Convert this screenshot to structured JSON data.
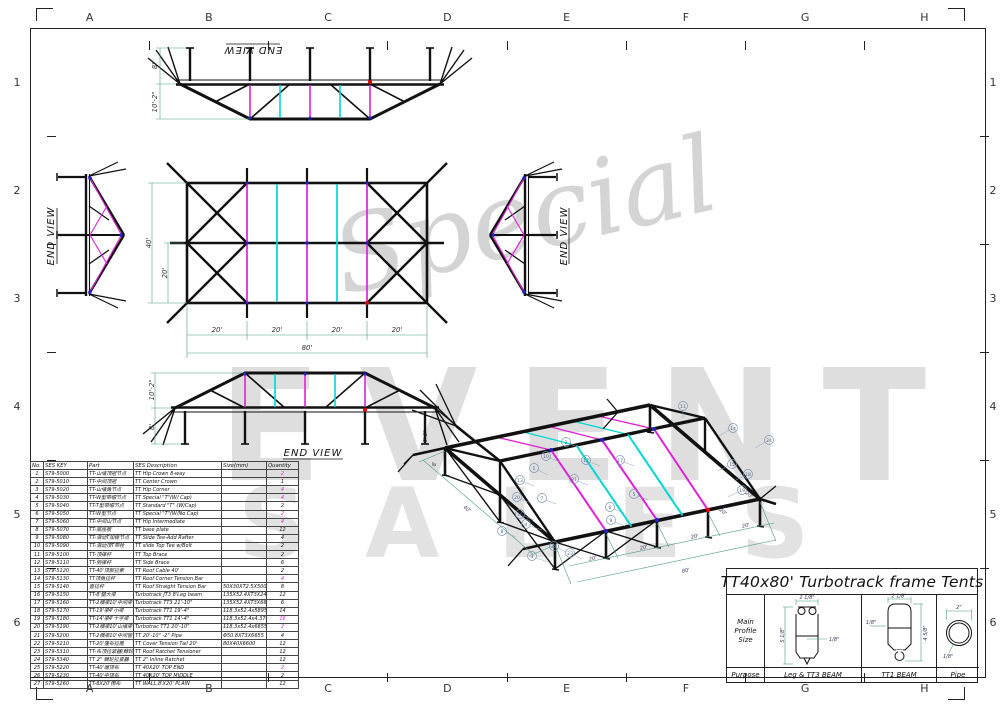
{
  "colors": {
    "magenta": "#e020d8",
    "cyan": "#00d6d6",
    "blue": "#2222c8",
    "red": "#e00000",
    "dim": "#4f9a86",
    "watermark": "#dcdcdc"
  },
  "sheet": {
    "grid_letters": [
      "A",
      "B",
      "C",
      "D",
      "E",
      "F",
      "G",
      "H"
    ],
    "grid_numbers": [
      "1",
      "2",
      "3",
      "4",
      "5",
      "6"
    ]
  },
  "watermark": {
    "script": "Special",
    "big": "EVENT",
    "bottom": "SALES"
  },
  "views": {
    "top_elev": {
      "label": "END VIEW",
      "dim_leg": "8'",
      "dim_roof": "10'-2\""
    },
    "left_end": {
      "label": "END VIEW"
    },
    "right_end": {
      "label": "END VIEW"
    },
    "plan": {
      "dim_width": "40'",
      "dim_half": "20'",
      "bay": "20'",
      "total": "80'"
    },
    "side_elev": {
      "label": "END VIEW",
      "dim_roof": "10'-2\"",
      "dim_leg": "8'"
    },
    "iso": {
      "balloons": [
        "1",
        "2",
        "3",
        "4",
        "5",
        "6",
        "7",
        "8",
        "9",
        "10",
        "11",
        "12",
        "13",
        "14",
        "15",
        "16",
        "17",
        "18",
        "19",
        "20",
        "21",
        "22",
        "23",
        "24"
      ],
      "dim_40": "40'",
      "dim_20": "20'",
      "dim_80": "80'",
      "dim_8": "8'",
      "dim_10": "10'-2\""
    }
  },
  "parts_table": {
    "headers": [
      "No.",
      "SES KEY",
      "Part",
      "SES Description",
      "Size(mm)",
      "Quantity"
    ],
    "rows": [
      {
        "no": "1",
        "key": "S79-5000",
        "part": "TT-山墙顶冠节点",
        "desc": "TT Hip Crown 8-way",
        "size": "",
        "qty": "2",
        "pink": true
      },
      {
        "no": "2",
        "key": "S79-5010",
        "part": "TT-中间顶冠",
        "desc": "TT Center Crown",
        "size": "",
        "qty": "1",
        "pink": false
      },
      {
        "no": "3",
        "key": "S79-5020",
        "part": "TT-山墙角节点",
        "desc": "TT Hip Corner",
        "size": "",
        "qty": "4",
        "pink": true
      },
      {
        "no": "4",
        "key": "S79-5030",
        "part": "TT-W型带帽节点",
        "desc": "TT Special \"T\"(W/ Cap)",
        "size": "",
        "qty": "4",
        "pink": true
      },
      {
        "no": "5",
        "key": "S79-5040",
        "part": "TT-T型带帽节点",
        "desc": "TT Standard \"T\" (W/Cap)",
        "size": "",
        "qty": "2",
        "pink": false
      },
      {
        "no": "6",
        "key": "S79-5050",
        "part": "TT-W型节点",
        "desc": "TT Special \"T\"(W/No Cap)",
        "size": "",
        "qty": "2",
        "pink": true
      },
      {
        "no": "7",
        "key": "S79-5060",
        "part": "TT-中间山节点",
        "desc": "TT Hip Intermediate",
        "size": "",
        "qty": "4",
        "pink": true
      },
      {
        "no": "8",
        "key": "S79-5070",
        "part": "TT-底座板",
        "desc": "TT base plate",
        "size": "",
        "qty": "12",
        "pink": false
      },
      {
        "no": "9",
        "key": "S79-5080",
        "part": "TT-滑动T加椽节点",
        "desc": "TT Slide Tee-Add Rafter",
        "size": "",
        "qty": "4",
        "pink": false
      },
      {
        "no": "10",
        "key": "S79-5090",
        "part": "TT-滑动顶T带栓",
        "desc": "TT slide Top Tee w/Bolt",
        "size": "",
        "qty": "2",
        "pink": false
      },
      {
        "no": "11",
        "key": "S79-5100",
        "part": "TT-顶撑杆",
        "desc": "TT Top Brace",
        "size": "",
        "qty": "2",
        "pink": false
      },
      {
        "no": "12",
        "key": "S79-5110",
        "part": "TT-侧撑杆",
        "desc": "TT Side  Brace",
        "size": "",
        "qty": "6",
        "pink": false
      },
      {
        "no": "13",
        "key": "S79-5120",
        "part": "TT-40'顶部拉索",
        "desc": "TT Roof Cable 40'",
        "size": "",
        "qty": "2",
        "pink": false
      },
      {
        "no": "14",
        "key": "S79-5130",
        "part": "TT顶角拉杆",
        "desc": "TT Roof Corner Tension Bar",
        "size": "",
        "qty": "4",
        "pink": true
      },
      {
        "no": "15",
        "key": "S79-5140",
        "part": "直拉杆",
        "desc": "TT Roof Straight Tension Bar",
        "size": "50X30XT2.5X500",
        "qty": "8",
        "pink": false
      },
      {
        "no": "16",
        "key": "S79-5150",
        "part": "TT-8'腿大梁",
        "desc": "Turbotrack JT3 8'Leg beam",
        "size": "135X52.4XT3X2430",
        "qty": "12",
        "pink": false
      },
      {
        "no": "17",
        "key": "S79-5160",
        "part": "TT-2横梁10'中间梁",
        "desc": "Turbotrack TT3 21'-10\"",
        "size": "135X52.4XT3X6655",
        "qty": "6",
        "pink": false
      },
      {
        "no": "18",
        "key": "S79-5170",
        "part": "TT-19'梁4'小梁",
        "desc": "Turbotrack TT1 19'-4\"",
        "size": "118.3x52.4x5895",
        "qty": "14",
        "pink": false
      },
      {
        "no": "19",
        "key": "S79-5180",
        "part": "TT-14'梁4'十字梁",
        "desc": "Turbotrack TT1 14'-4\"",
        "size": "118.3x52.4x4,370",
        "qty": "16",
        "pink": true
      },
      {
        "no": "20",
        "key": "S79-5190",
        "part": "TT-2横梁10'山墙梁",
        "desc": "Turbotrac TT1 20'-10\"",
        "size": "118.3x52.4x6655",
        "qty": "2",
        "pink": true
      },
      {
        "no": "21",
        "key": "S79-5200",
        "part": "TT-2横梁10'中间管",
        "desc": "TT 20'-10\" -2\" Pipe",
        "size": "Φ50.8XT3X6655",
        "qty": "4",
        "pink": false
      },
      {
        "no": "22",
        "key": "S79-5210",
        "part": "TT-20'篷布拉尾",
        "desc": "TT Cover Tension Tail 20'",
        "size": "80X40X6600",
        "qty": "12",
        "pink": false
      },
      {
        "no": "23",
        "key": "S79-5310",
        "part": "TT-布顶拉紧器(棘轮式)",
        "desc": "TT Roof Ratchet Tensioner",
        "size": "",
        "qty": "12",
        "pink": false
      },
      {
        "no": "24",
        "key": "S79-5340",
        "part": "TT 2\" 棘轮拉紧器",
        "desc": "TT 2\" Inline Ratchet",
        "size": "",
        "qty": "12",
        "pink": false
      },
      {
        "no": "25",
        "key": "S79-5220",
        "part": "TT-40'端顶布",
        "desc": "TT 40X20' TOP END",
        "size": "",
        "qty": "2",
        "pink": true
      },
      {
        "no": "26",
        "key": "S79-5230",
        "part": "TT-40'中顶布",
        "desc": "TT 40X20' TOP MIDDLE",
        "size": "",
        "qty": "2",
        "pink": false
      },
      {
        "no": "27",
        "key": "S79-5260",
        "part": "TT-8X20'围布",
        "desc": "TT WALL,8'X20' PLAIN",
        "size": "",
        "qty": "12",
        "pink": false
      }
    ]
  },
  "title_block": {
    "title": "TT40x80' Turbotrack frame Tents",
    "main_profile": "Main Profile Size",
    "purpose": "Purpose",
    "profiles": [
      {
        "name": "Leg & TT3 BEAM",
        "w": "2 1/8\"",
        "h": "5 1/8\"",
        "t": "1/8\""
      },
      {
        "name": "TT1 BEAM",
        "w": "2 1/8\"",
        "h": "4 5/8\"",
        "t": "1/8\""
      },
      {
        "name": "Pipe",
        "w": "2\"",
        "t": "1/8\""
      }
    ]
  }
}
